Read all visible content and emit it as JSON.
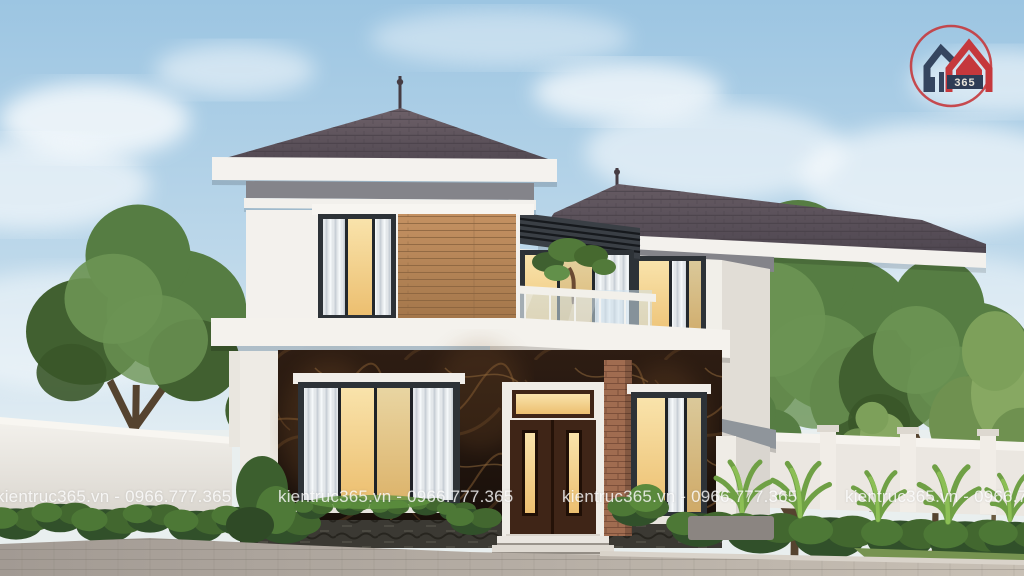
{
  "image": {
    "type": "3D architectural exterior render",
    "subject": "Modern two-storey hip-roof villa with wood and marble cladding, glass balcony, landscaped yard, white boundary walls and paved driveway"
  },
  "watermark": {
    "text": "kientruc365.vn - 0966.777.365",
    "color": "#ffffff",
    "opacity": 0.8,
    "count": 4
  },
  "logo": {
    "text": "365",
    "ring_color": "#c5383c",
    "left_house_color": "#35455f",
    "right_house_color": "#c5383c",
    "banner_color": "#2e3c55"
  },
  "palette": {
    "sky": "#a6cbe5",
    "roof_tiles": "#5f5560",
    "wall_white": "#f3f1ed",
    "wood_cladding": "#b5854f",
    "marble_dark": "#241711",
    "window_glow": "#f2cd8a",
    "window_frame": "#2d3237",
    "foliage": "#4e7340",
    "driveway": "#b5aca3",
    "fence": "#ebe7e1"
  }
}
